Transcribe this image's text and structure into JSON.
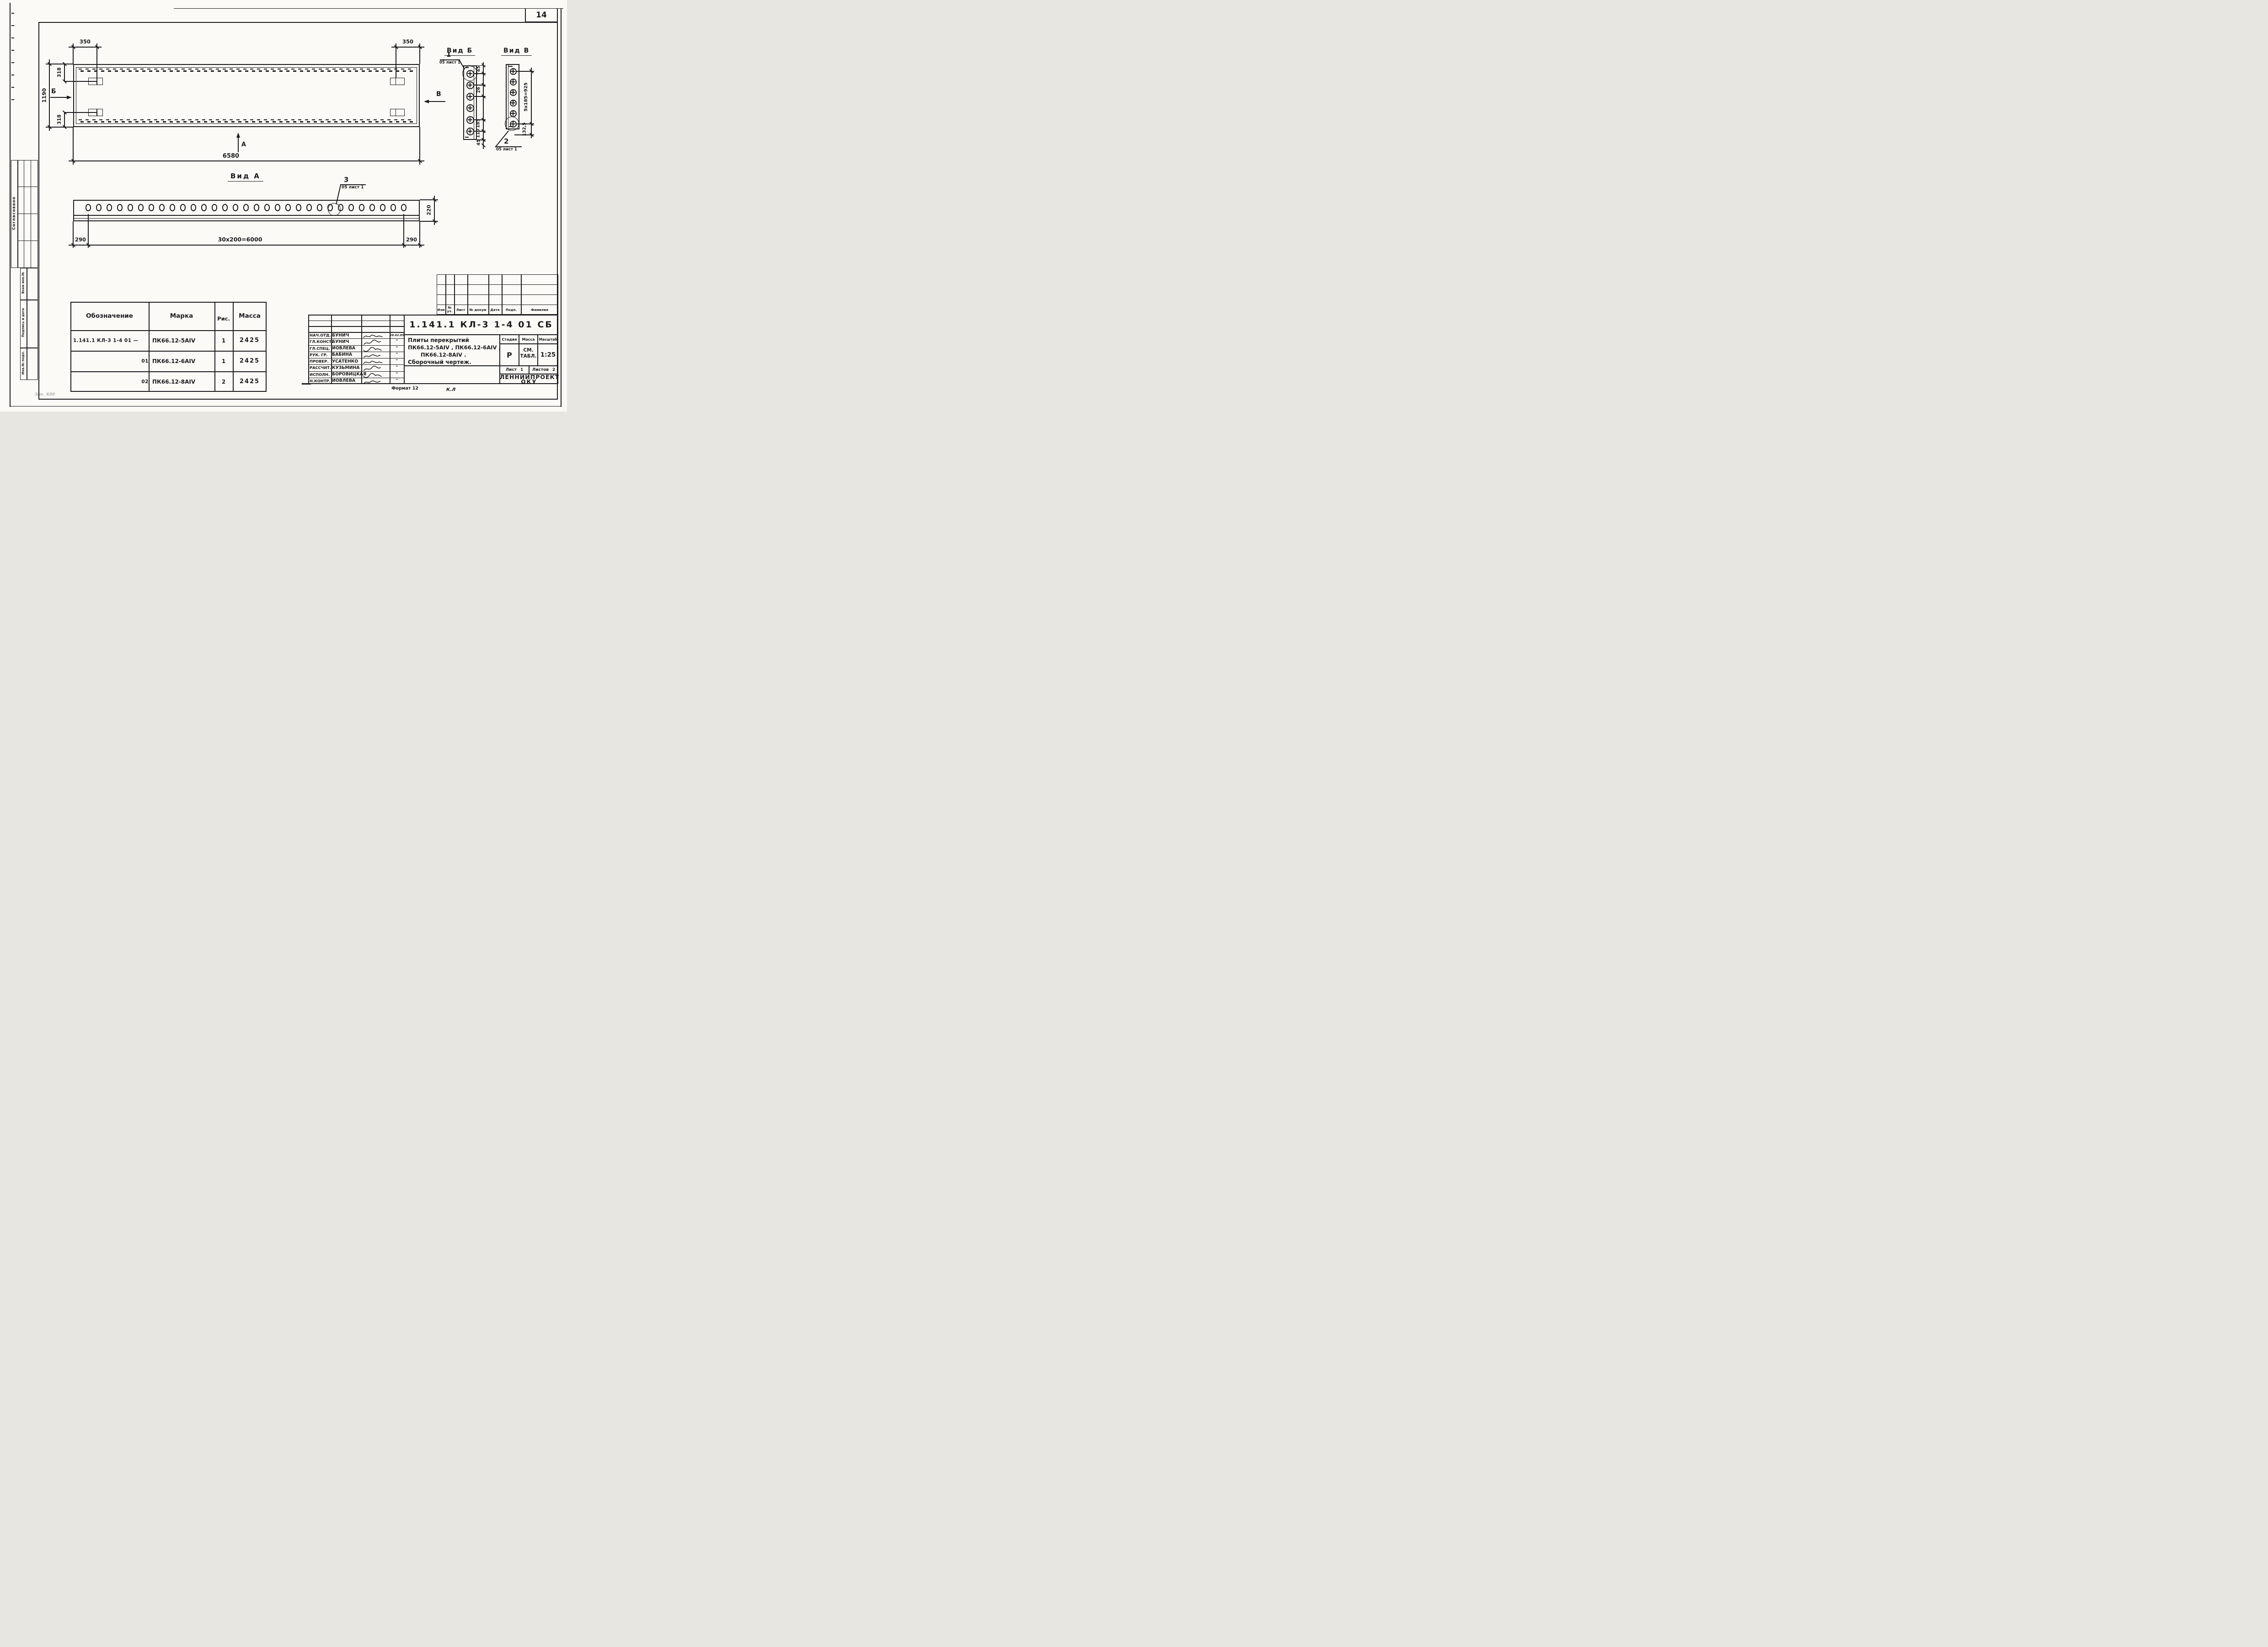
{
  "page": {
    "number": "14",
    "format_note": "Формат 12",
    "sheet_code": "К.Л",
    "stamp_note": "Зак. 620"
  },
  "sidebar": {
    "agreed_label": "Согласовано",
    "vzam_label": "Взам инв.№",
    "podpis_label": "Подпись и дата",
    "inv_label": "Инв.№ подп."
  },
  "plan": {
    "dim_350_left": "350",
    "dim_350_right": "350",
    "dim_1190": "1190",
    "dim_318_top": "318",
    "dim_318_bottom": "318",
    "dim_6580": "6580",
    "section_b_label": "Б",
    "section_v_label": "В",
    "section_a_label": "А"
  },
  "vid_a": {
    "title": "Вид А",
    "hole_count": 31,
    "dim_left": "290",
    "dim_pitch": "30х200=6000",
    "dim_right": "290",
    "dim_height": "220",
    "detail_num": "3",
    "detail_ref": "05 лист 1"
  },
  "vid_b": {
    "title": "Вид Б",
    "hole_count": 6,
    "dims": [
      "45",
      "26",
      "185",
      "110",
      "45"
    ],
    "detail_num": "1",
    "detail_ref": "05 лист 1"
  },
  "vid_v": {
    "title": "Вид В",
    "hole_count": 6,
    "dim_pitch": "5х185=925",
    "dim_bottom": "132,5",
    "detail_num": "2",
    "detail_ref": "05 лист 1"
  },
  "parts_table": {
    "headers": [
      "Обозначение",
      "Марка",
      "Рис.",
      "Масса"
    ],
    "rows": [
      [
        "1.141.1 КЛ-3  1-4  01   —",
        "ПК66.12-5АIV",
        "1",
        "2425"
      ],
      [
        "01",
        "ПК66.12-6АIV",
        "1",
        "2425"
      ],
      [
        "02",
        "ПК66.12-8АIV",
        "2",
        "2425"
      ]
    ]
  },
  "revision_strip": {
    "headers": [
      "Изм",
      "№ уч.",
      "Лист",
      "№ докум",
      "Дата",
      "Подп.",
      "Фамилия"
    ]
  },
  "title_block": {
    "designation": "1.141.1 КЛ-3   1-4   01 СБ",
    "name_lines": [
      "Плиты перекрытий",
      "ПК66.12-5АIV , ПК66.12-6АIV ,",
      "ПК66.12-8АIV .",
      "Сборочный чертеж."
    ],
    "stage_label": "Стадия",
    "mass_label": "Масса",
    "scale_label": "Масштаб",
    "stage_value": "Р",
    "mass_value_line1": "СМ.",
    "mass_value_line2": "ТАБЛ.",
    "scale_value": "1:25",
    "sheet_label": "Лист",
    "sheet_value": "1",
    "sheets_label": "Листов",
    "sheets_value": "2",
    "org_line1": "ЛЕННИИПРОЕКТ",
    "org_line2": "ОКУ",
    "staff": [
      {
        "role": "НАЧ.ОТД.",
        "name": "БУНИЧ",
        "date": "28.02.85"
      },
      {
        "role": "ГЛ.КОНСТ.",
        "name": "БУНИЧ",
        "date": "\""
      },
      {
        "role": "ГЛ.СПЕЦ.",
        "name": "ИОВЛЕВА",
        "date": "\""
      },
      {
        "role": "РУК. ГР.",
        "name": "БАБИНА",
        "date": "\""
      },
      {
        "role": "ПРОВЕР.",
        "name": "УСАТЕНКО",
        "date": "\""
      },
      {
        "role": "РАССЧИТ.",
        "name": "КУЗЬМИНА",
        "date": "\""
      },
      {
        "role": "ИСПОЛН.",
        "name": "БОРОВИЦКАЯ",
        "date": "\""
      },
      {
        "role": "Н.КОНТР.",
        "name": "ИОВЛЕВА",
        "date": "\""
      }
    ]
  }
}
